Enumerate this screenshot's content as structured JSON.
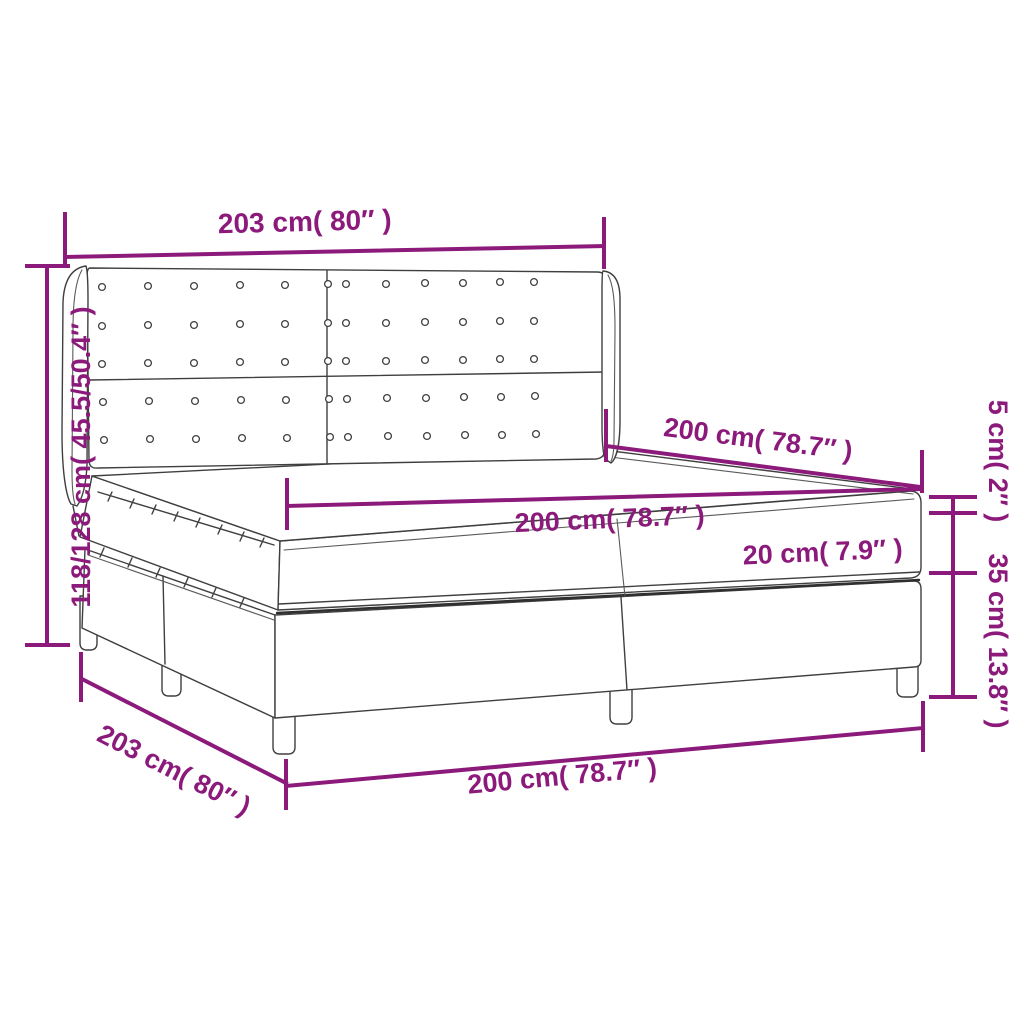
{
  "diagram": {
    "type": "product-dimension-diagram",
    "subject": "box spring bed with winged button-tufted headboard, mattress and topper",
    "colors": {
      "dimension_accent": "#8B1A7B",
      "line_art": "#3f3f3f",
      "background": "#ffffff"
    },
    "labels": {
      "headboard_width": "203 cm( 80″ )",
      "height_range": "118/128 cm( 45.5/50.4″ )",
      "length_top": "200 cm( 78.7″ )",
      "mattress_width": "200 cm( 78.7″ )",
      "mattress_thickness": "20 cm( 7.9″ )",
      "topper_thickness": "5 cm( 2″ )",
      "base_height": "35 cm( 13.8″ )",
      "base_width_diagonal": "203 cm( 80″ )",
      "length_bottom": "200 cm( 78.7″ )"
    },
    "measurements": {
      "headboard_width_cm": 203,
      "headboard_width_in": 80,
      "height_min_cm": 118,
      "height_max_cm": 128,
      "height_min_in": 45.5,
      "height_max_in": 50.4,
      "bed_length_cm": 200,
      "bed_length_in": 78.7,
      "mattress_width_cm": 200,
      "mattress_width_in": 78.7,
      "mattress_thickness_cm": 20,
      "mattress_thickness_in": 7.9,
      "topper_thickness_cm": 5,
      "topper_thickness_in": 2,
      "base_height_cm": 35,
      "base_height_in": 13.8
    }
  }
}
